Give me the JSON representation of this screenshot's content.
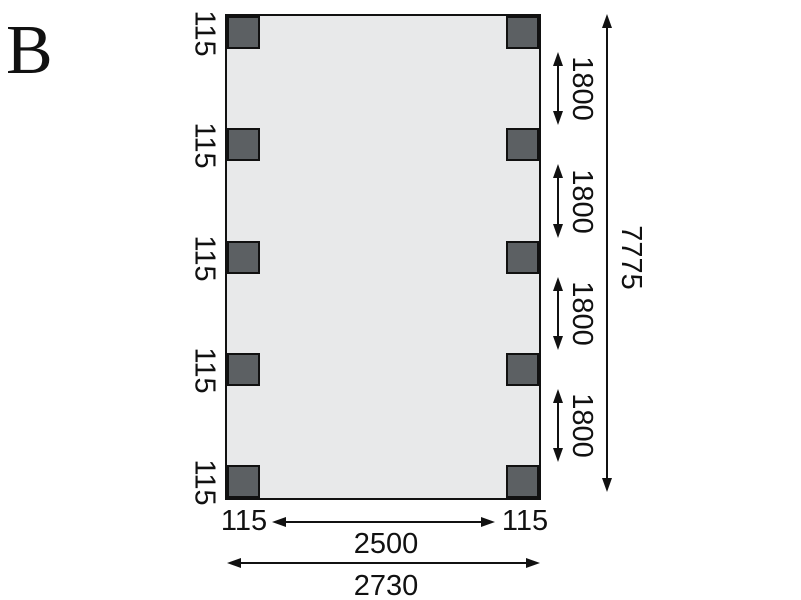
{
  "diagram": {
    "view_label": "B",
    "colors": {
      "plan_fill": "#e8e9ea",
      "post_fill": "#5c6063",
      "line": "#111111"
    },
    "posts": {
      "per_side": 5,
      "count": 10
    },
    "dimensions": {
      "left_post_labels": [
        "115",
        "115",
        "115",
        "115",
        "115"
      ],
      "right_gap_labels": [
        "1800",
        "1800",
        "1800",
        "1800"
      ],
      "overall_height_label": "7775",
      "bottom_left_post_label": "115",
      "bottom_inner_span_label": "2500",
      "bottom_right_post_label": "115",
      "bottom_overall_width_label": "2730"
    }
  }
}
